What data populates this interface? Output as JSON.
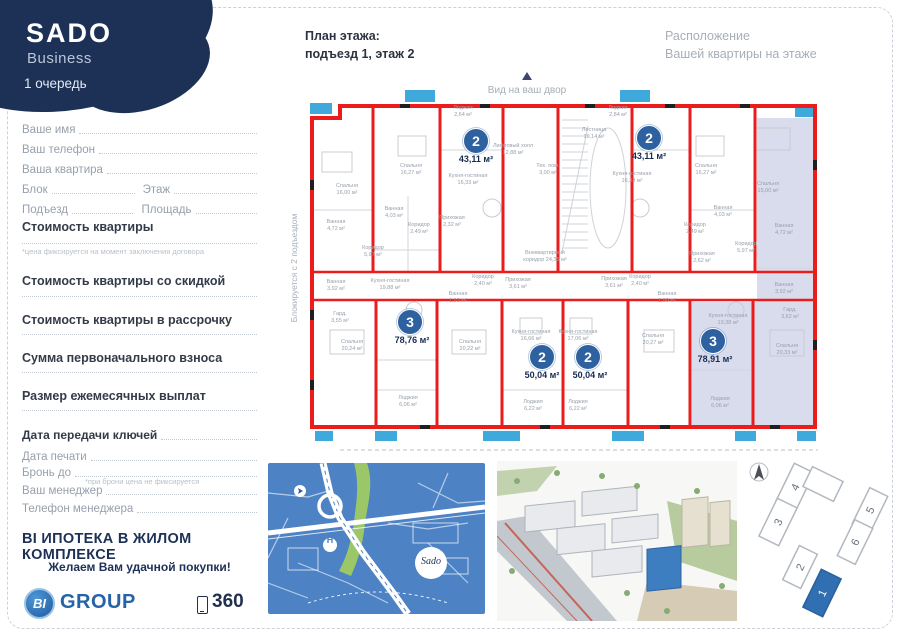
{
  "brand": {
    "name": "SADO",
    "line": "Business",
    "phase": "1 очередь"
  },
  "form": {
    "full_rows": [
      "Ваше имя",
      "Ваш телефон",
      "Ваша квартира"
    ],
    "split_rows": [
      {
        "left": "Блок",
        "right": "Этаж"
      },
      {
        "left": "Подъезд",
        "right": "Площадь"
      }
    ]
  },
  "pricing": [
    {
      "title": "Стоимость квартиры",
      "note": "*цена фиксируется на момент заключения договора"
    },
    {
      "title": "Стоимость квартиры со скидкой"
    },
    {
      "title": "Стоимость квартиры в рассрочку"
    },
    {
      "title": "Сумма первоначального взноса"
    },
    {
      "title": "Размер ежемесячных выплат"
    }
  ],
  "meta": [
    {
      "label": "Дата передачи ключей"
    },
    {
      "label": "Дата печати"
    },
    {
      "label": "Бронь до",
      "note": "*при брони цена не фиксируется"
    },
    {
      "label": "Ваш менеджер"
    },
    {
      "label": "Телефон менеджера"
    }
  ],
  "footer": {
    "mortgage": "BI ИПОТЕКА В ЖИЛОМ КОМПЛЕКСЕ",
    "wish": "Желаем Вам удачной покупки!",
    "logo_bi": "BI",
    "logo_group": "GROUP",
    "view360": "360"
  },
  "plan": {
    "title": "План этажа:",
    "subtitle": "подъезд 1, этаж 2",
    "location1": "Расположение",
    "location2": "Вашей квартиры на этаже",
    "yard": "Вид на ваш двор",
    "blocked": "Блокируется с 2 подъездом",
    "apartments": [
      {
        "num": "2",
        "area": "43,11 м²"
      },
      {
        "num": "2",
        "area": "43,11 м²"
      },
      {
        "num": "3",
        "area": "78,76 м²"
      },
      {
        "num": "2",
        "area": "50,04 м²"
      },
      {
        "num": "2",
        "area": "50,04 м²"
      },
      {
        "num": "3",
        "area": "78,91 м²"
      }
    ],
    "rooms": [
      "Спальня\n16,00 м²",
      "Ванная\n4,72 м²",
      "Коридор\n5,97 м²",
      "Гард.\n3,55 м²",
      "Ванная\n3,92 м²",
      "Спальня\n20,24 м²",
      "Спальня\n16,27 м²",
      "Ванная\n4,03 м²",
      "Коридор\n2,49 м²",
      "Прихожая\n2,32 м²",
      "Кухня-гостиная\n16,33 м²",
      "Лоджия\n2,64 м²",
      "Лифтовый холл\n12,88 м²",
      "Тех. пом.\n3,00 м²",
      "Лестница\n19,14 м²",
      "Лоджия\n2,84 м²",
      "Кухня-гостиная\n16,33 м²",
      "Спальня\n16,27 м²",
      "Ванная\n4,03 м²",
      "Коридор\n2,49 м²",
      "Прихожая\n2,62 м²",
      "Коридор\n5,97 м²",
      "Ванная\n4,72 м²",
      "Спальня\n15,00 м²",
      "Внеквартирный\nкоридор 24,35 м²",
      "Кухня-гостиная\n19,88 м²",
      "Ванная\n1,93 м²",
      "Коридор\n2,40 м²",
      "Прихожая\n3,61 м²",
      "Спальня\n20,22 м²",
      "Лоджия\n6,06 м²",
      "Кухня-гостиная\n16,66 м²",
      "Лоджия\n6,22 м²",
      "Кухня-гостиная\n17,06 м²",
      "Лоджия\n6,22 м²",
      "Коридор\n2,40 м²",
      "Ванная\n1,99 м²",
      "Спальня\n20,27 м²",
      "Кухня-гостиная\n19,38 м²",
      "Гард.\n3,62 м²",
      "Ванная\n3,92 м²",
      "Спальня\n20,33 м²",
      "Лоджия\n6,06 м²",
      "Прихожая\n3,61 м²"
    ]
  },
  "map": {
    "complex": "Sado",
    "hospital": "H"
  },
  "site": {
    "blocks": [
      "1",
      "2",
      "3",
      "4",
      "5",
      "6"
    ]
  },
  "colors": {
    "accent_navy": "#1d3156",
    "wall_red": "#ea1c1c",
    "balcony_blue": "#3fa9dc",
    "badge_blue": "#2e619f",
    "highlight": "#d9dcec",
    "map_blue": "#4d82c4",
    "map_green": "#9cc768",
    "bigroup_blue": "#2563a8"
  }
}
